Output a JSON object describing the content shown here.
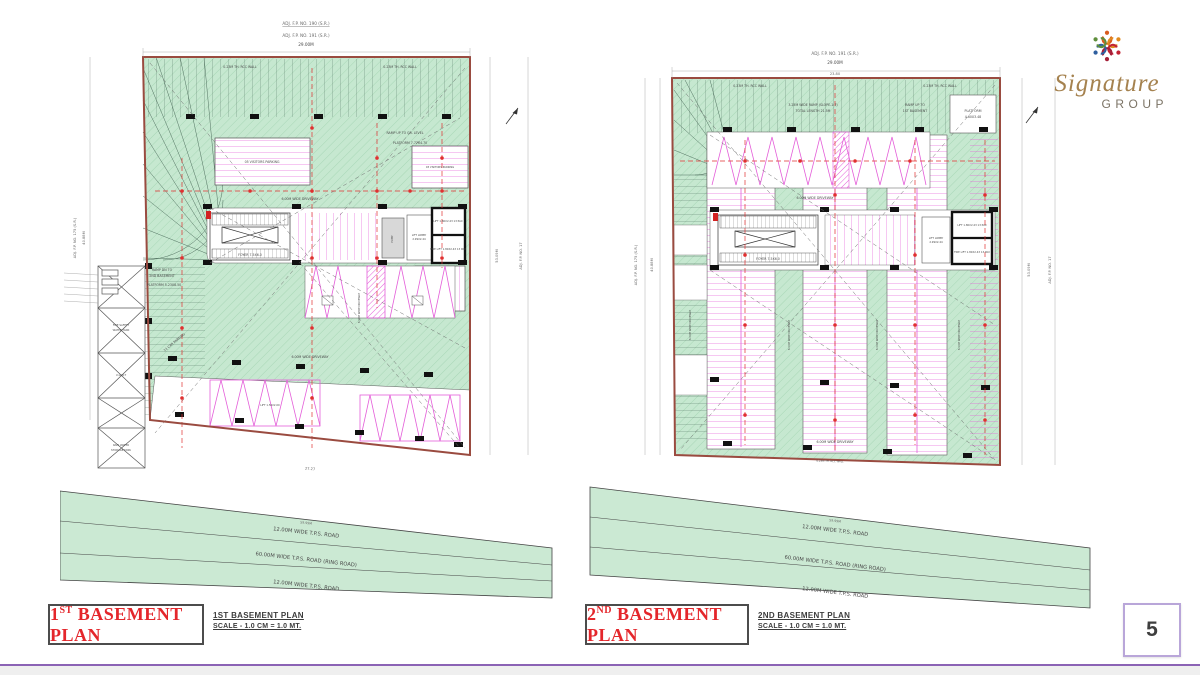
{
  "page": {
    "number": "5"
  },
  "logo": {
    "brand": "Signature",
    "group": "GROUP"
  },
  "shared": {
    "roads": [
      "12.00M WIDE T.P.S. ROAD",
      "60.00M WIDE T.P.S. ROAD (RING ROAD)",
      "12.00M WIDE T.P.S. ROAD"
    ],
    "road_dim": "59.99M",
    "driveway": "6.00M WIDE DRIVEWAY",
    "rcc": "0.23M TH. RCC WALL",
    "lift": "LIFT 1.80X2.43 13 PAX",
    "fire_lift": "FIRE LIFT 1.80X2.43 13 PAX",
    "lobby1": "LIFT LOBBY",
    "lobby2": "2.99X2.44",
    "foyer": "FOYER 7.5X6.0",
    "pump": "PUMP",
    "adj_top": "ADJ. F.P. NO. 191 (S.R.)",
    "adj_top_dim": "29.00M",
    "adj_left": "ADJ. F.P. NO. 175 (S.R.)",
    "adj_left_dim": "40.88M",
    "adj_right_dim": "53.09M",
    "adj_right": "ADJ. F.P. NO. 17"
  },
  "plan1": {
    "title": {
      "num": "1",
      "sup": "ST",
      "rest": " BASEMENT PLAN"
    },
    "caption": {
      "line1": "1ST BASEMENT PLAN",
      "line2": "SCALE - 1.0 CM = 1.0 MT."
    },
    "notes": {
      "top_underline": "ADJ. F.P. NO. 190 (S.R.)",
      "bottom_dim": "27.27"
    },
    "labels": {
      "ramp_up": "RAMP UP TO GR. LEVEL",
      "platform_top": "PLATFORM 7.77X4.70",
      "visitors": "05 VISITORS PARKING",
      "visitors2": "03 VISITORS PARKING",
      "ramp_dn1": "RAMP DN TO",
      "ramp_dn2": "2ND BASEMENT",
      "platform_left": "PLATFORM 5.23X8.50",
      "car_parking": "21 CAR PARKING",
      "fire_tank1": "FIRE SAFETY",
      "fire_tank2": "WATER TANK",
      "ugwt": "U.G.W.T",
      "rain_tank1": "RAIN WATER",
      "rain_tank2": "STORAGE TANK",
      "lift_small": "LIFT 1.50X2.00"
    }
  },
  "plan2": {
    "title": {
      "num": "2",
      "sup": "ND",
      "rest": " BASEMENT PLAN"
    },
    "caption": {
      "line1": "2ND BASEMENT PLAN",
      "line2": "SCALE - 1.0 CM = 1.0 MT."
    },
    "notes": {
      "inner_dim": "23.80"
    },
    "labels": {
      "ramp1": "3.25M WIDE RAMP (SLOPE-1:7)",
      "ramp2": "TOTAL LENGTH 21.5M",
      "ramp_up1": "RAMP UP TO",
      "ramp_up2": "1ST BASEMENT",
      "platform1": "PLATFORM",
      "platform2": "4.60X3.48"
    }
  }
}
